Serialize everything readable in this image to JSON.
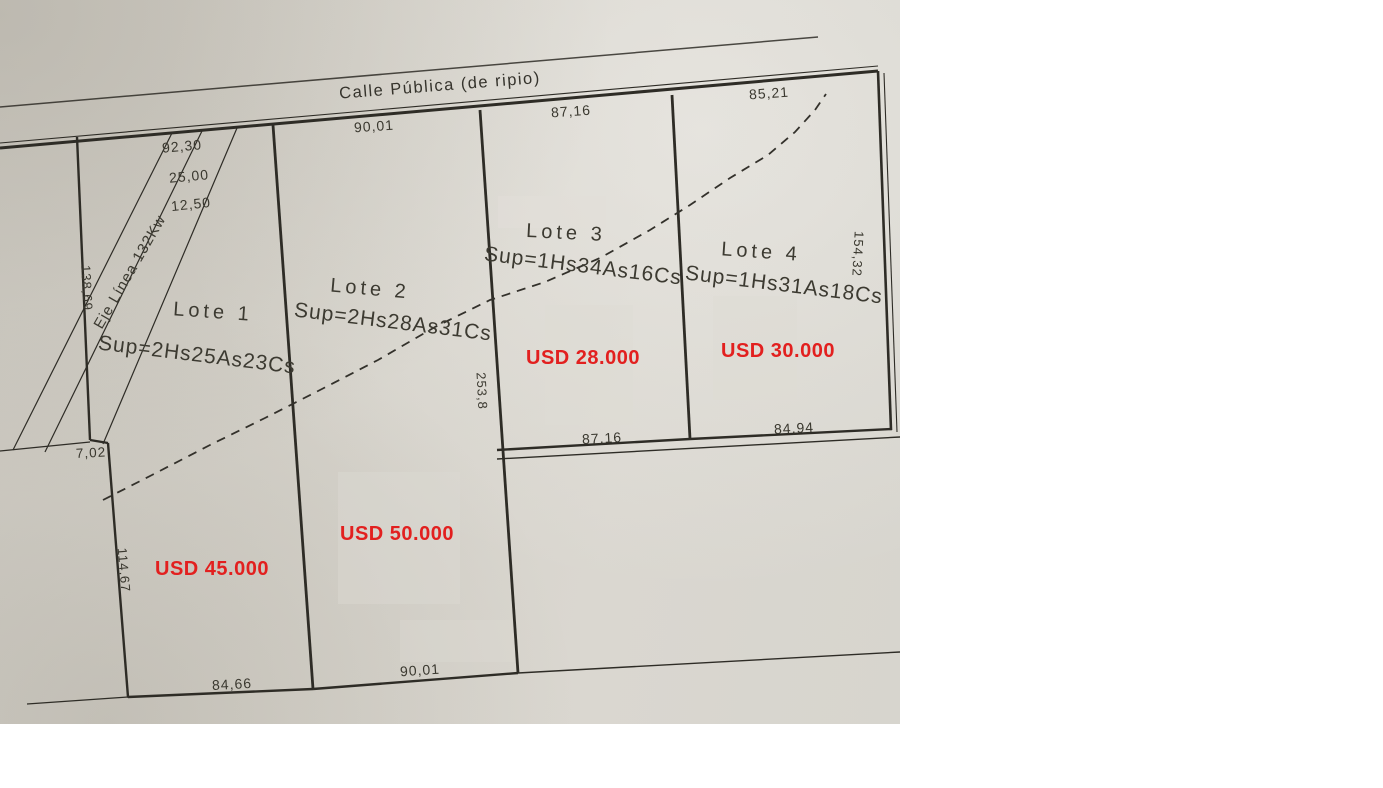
{
  "street": {
    "label": "Calle Pública (de ripio)"
  },
  "easement": {
    "label": "Eje Línea 132Kw"
  },
  "lots": [
    {
      "name": "Lote 1",
      "surface": "Sup=2Hs25As23Cs",
      "price": "USD 45.000"
    },
    {
      "name": "Lote 2",
      "surface": "Sup=2Hs28As31Cs",
      "price": "USD 50.000"
    },
    {
      "name": "Lote 3",
      "surface": "Sup=1Hs34As16Cs",
      "price": "USD 28.000"
    },
    {
      "name": "Lote 4",
      "surface": "Sup=1Hs31As18Cs",
      "price": "USD 30.000"
    }
  ],
  "dimensions": {
    "top_lote1": "92,30",
    "easement_width": "25,00",
    "easement_half": "12,50",
    "top_lote2": "90,01",
    "top_lote3": "87,16",
    "top_lote4": "85,21",
    "west_upper": "138,69",
    "west_jog": "7,02",
    "west_lower": "114,67",
    "bottom_lote1": "84,66",
    "bottom_lote2": "90,01",
    "mid_lote3": "87,16",
    "mid_lote4": "84,94",
    "east_lote4": "154,32",
    "east_lote2": "253,8"
  },
  "colors": {
    "price_red": "#e2201f",
    "ink": "#2e2c26",
    "paper": "#d5d2ca"
  }
}
